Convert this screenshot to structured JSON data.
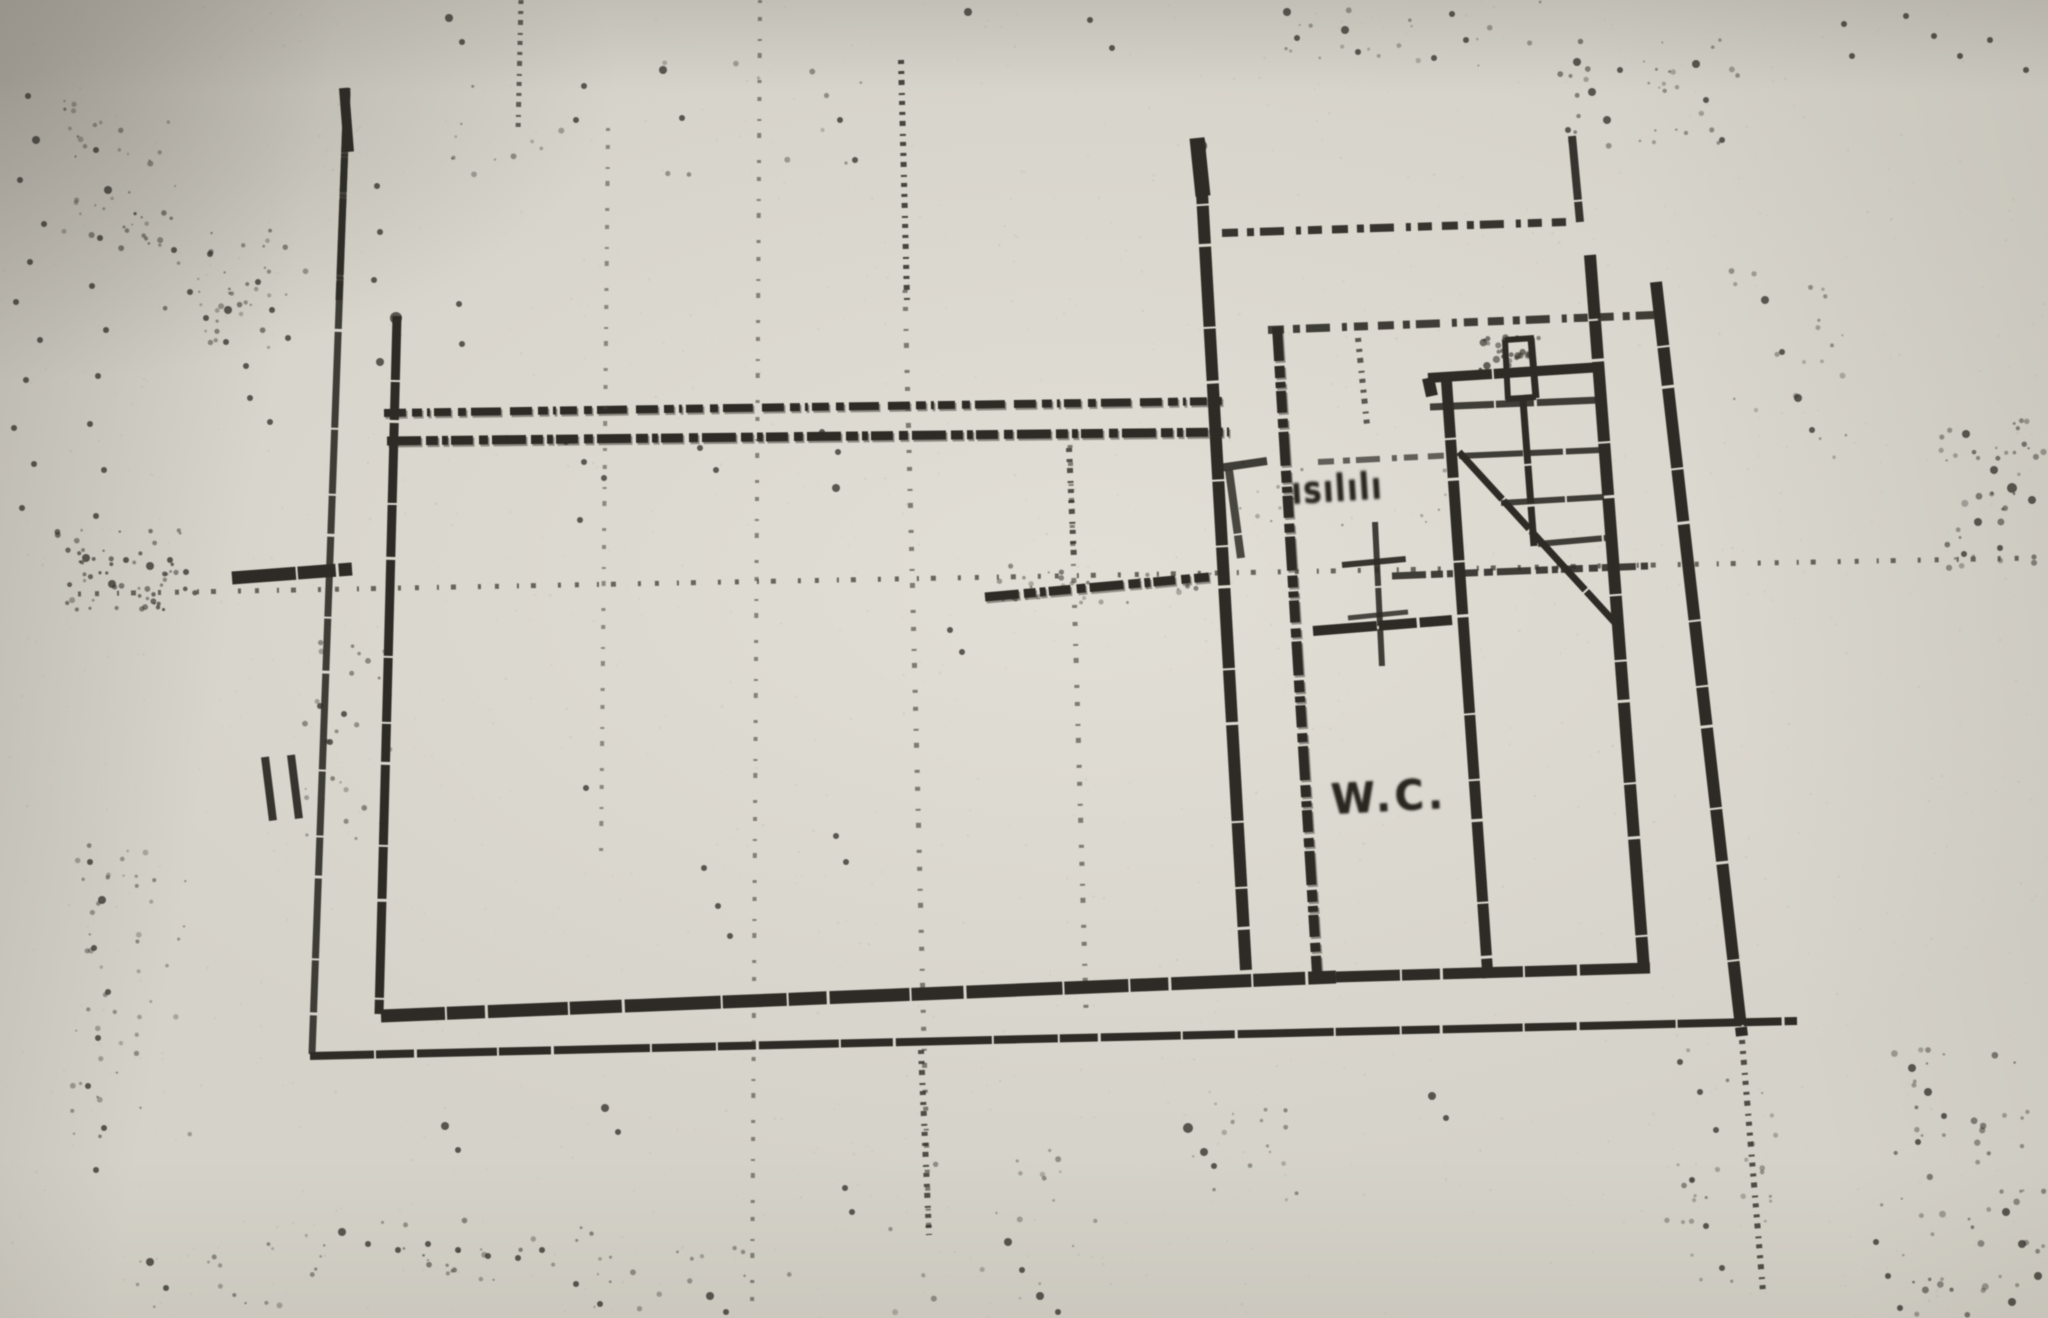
{
  "labels": {
    "wc": "W.C.",
    "stairs_annotation": "ısılılı"
  },
  "colors": {
    "paper": "#d5d2c9",
    "ink": "#2e2b26",
    "ink_faint": "#4a463f"
  },
  "plan": {
    "dash_presets": {
      "A": "22 6 10 5 3 4 17 7 8 5 30 9",
      "B": "34 5 12 4 6 3 22 6 9 4",
      "C": "16 9 7 6 24 12 5 7 14 10",
      "D": "4 7 3 6 5 8 2 6",
      "E": "3 14 4 18 2 12 5 22",
      "S": "64 2 38 3 80 2 52 3 96 2"
    },
    "solid": [
      [
        1199,
        140,
        1246,
        970,
        12,
        1
      ],
      [
        1197,
        138,
        1203,
        196,
        15,
        1
      ],
      [
        397,
        316,
        379,
        1014,
        9,
        1
      ],
      [
        381,
        1016,
        1336,
        977,
        13,
        1
      ],
      [
        1336,
        977,
        1650,
        968,
        11,
        1
      ],
      [
        1446,
        374,
        1488,
        978,
        11,
        1
      ],
      [
        1428,
        378,
        1602,
        367,
        10,
        1
      ],
      [
        1590,
        255,
        1644,
        970,
        12,
        1
      ],
      [
        1656,
        282,
        1742,
        1036,
        12,
        1
      ],
      [
        310,
        1056,
        1797,
        1021,
        8,
        1
      ],
      [
        347,
        88,
        312,
        1054,
        7,
        0.9
      ],
      [
        344,
        88,
        349,
        152,
        10,
        1
      ],
      [
        1313,
        631,
        1452,
        620,
        10,
        1
      ],
      [
        1523,
        400,
        1534,
        546,
        7,
        1
      ],
      [
        1459,
        452,
        1618,
        626,
        7,
        1
      ],
      [
        1505,
        340,
        1534,
        338,
        6,
        1
      ],
      [
        1505,
        340,
        1508,
        400,
        6,
        1
      ],
      [
        1531,
        338,
        1536,
        398,
        7,
        1
      ],
      [
        1506,
        399,
        1536,
        397,
        6,
        1
      ],
      [
        1375,
        522,
        1382,
        666,
        6,
        0.9
      ],
      [
        1342,
        565,
        1406,
        559,
        6,
        0.95
      ],
      [
        1348,
        618,
        1408,
        612,
        5,
        0.85
      ],
      [
        1572,
        136,
        1580,
        222,
        8,
        0.95
      ],
      [
        1430,
        407,
        1599,
        400,
        7,
        0.9
      ],
      [
        1459,
        456,
        1601,
        450,
        6,
        0.9
      ],
      [
        1501,
        503,
        1604,
        497,
        6,
        0.9
      ],
      [
        1538,
        544,
        1606,
        538,
        6,
        0.9
      ],
      [
        232,
        578,
        352,
        569,
        13,
        1
      ],
      [
        265,
        757,
        273,
        821,
        8,
        0.95
      ],
      [
        291,
        755,
        299,
        819,
        8,
        0.95
      ],
      [
        1219,
        468,
        1267,
        461,
        8,
        0.9
      ],
      [
        1229,
        470,
        1241,
        558,
        8,
        0.85
      ],
      [
        1428,
        378,
        1432,
        396,
        12,
        1
      ]
    ],
    "dashed": [
      [
        384,
        413,
        1226,
        401,
        8,
        "A",
        1,
        1
      ],
      [
        387,
        441,
        1229,
        432,
        9,
        "B",
        1,
        1
      ],
      [
        1222,
        233,
        1566,
        222,
        8,
        "C",
        0.95,
        0
      ],
      [
        1268,
        330,
        1654,
        315,
        8,
        "C",
        0.9,
        0
      ],
      [
        1277,
        327,
        1317,
        974,
        10,
        "B",
        1,
        1
      ],
      [
        78,
        594,
        2035,
        558,
        5,
        "E",
        0.8,
        0
      ],
      [
        985,
        597,
        1209,
        577,
        9,
        "B",
        1,
        1
      ],
      [
        1392,
        576,
        1648,
        566,
        7,
        "B",
        0.9,
        0
      ],
      [
        1318,
        462,
        1457,
        455,
        6,
        "C",
        0.7,
        0
      ],
      [
        1742,
        1040,
        1763,
        1292,
        6,
        "D",
        0.8,
        0
      ],
      [
        901,
        60,
        907,
        300,
        6,
        "D",
        0.85,
        0
      ],
      [
        521,
        0,
        518,
        132,
        5,
        "D",
        0.7,
        0
      ],
      [
        608,
        128,
        601,
        860,
        4,
        "E",
        0.55,
        0
      ],
      [
        760,
        0,
        752,
        1318,
        4,
        "E",
        0.6,
        0
      ],
      [
        905,
        290,
        929,
        1240,
        5,
        "E",
        0.65,
        0
      ],
      [
        921,
        1050,
        929,
        1235,
        6,
        "D",
        0.8,
        0
      ],
      [
        1070,
        445,
        1086,
        1008,
        5,
        "E",
        0.65,
        0
      ],
      [
        1069,
        448,
        1074,
        560,
        6,
        "D",
        0.8,
        0
      ],
      [
        1358,
        338,
        1367,
        425,
        6,
        "D",
        0.75,
        0
      ],
      [
        347,
        92,
        339,
        300,
        7,
        "S",
        0.85,
        0
      ]
    ],
    "specks": [
      [
        1287,
        12,
        4
      ],
      [
        1297,
        38,
        3
      ],
      [
        1345,
        30,
        4
      ],
      [
        1358,
        52,
        3
      ],
      [
        968,
        12,
        4
      ],
      [
        1090,
        20,
        3
      ],
      [
        1112,
        48,
        3
      ],
      [
        449,
        18,
        4
      ],
      [
        462,
        42,
        3
      ],
      [
        663,
        70,
        4
      ],
      [
        682,
        118,
        3
      ],
      [
        576,
        120,
        3
      ],
      [
        584,
        86,
        3
      ],
      [
        840,
        120,
        3
      ],
      [
        855,
        160,
        3
      ],
      [
        1577,
        62,
        4
      ],
      [
        1592,
        92,
        4
      ],
      [
        1607,
        120,
        4
      ],
      [
        1568,
        130,
        3
      ],
      [
        1620,
        70,
        3
      ],
      [
        1696,
        64,
        4
      ],
      [
        1706,
        100,
        3
      ],
      [
        1722,
        140,
        3
      ],
      [
        1844,
        24,
        3
      ],
      [
        1852,
        56,
        3
      ],
      [
        1960,
        56,
        3
      ],
      [
        1990,
        40,
        3
      ],
      [
        2026,
        70,
        3
      ],
      [
        1906,
        16,
        3
      ],
      [
        1934,
        36,
        3
      ],
      [
        1452,
        14,
        3
      ],
      [
        1466,
        40,
        3
      ],
      [
        1434,
        58,
        3
      ],
      [
        1765,
        300,
        4
      ],
      [
        1782,
        352,
        3
      ],
      [
        1798,
        398,
        4
      ],
      [
        1812,
        430,
        3
      ],
      [
        1966,
        434,
        4
      ],
      [
        1994,
        470,
        4
      ],
      [
        2012,
        488,
        5
      ],
      [
        2032,
        500,
        4
      ],
      [
        1978,
        522,
        4
      ],
      [
        2000,
        548,
        3
      ],
      [
        1964,
        554,
        3
      ],
      [
        700,
        448,
        3
      ],
      [
        716,
        470,
        3
      ],
      [
        566,
        442,
        3
      ],
      [
        584,
        462,
        3
      ],
      [
        604,
        478,
        3
      ],
      [
        822,
        432,
        3
      ],
      [
        838,
        452,
        3
      ],
      [
        836,
        488,
        4
      ],
      [
        580,
        520,
        3
      ],
      [
        950,
        630,
        3
      ],
      [
        962,
        652,
        3
      ],
      [
        836,
        836,
        3
      ],
      [
        846,
        862,
        3
      ],
      [
        586,
        788,
        3
      ],
      [
        704,
        868,
        3
      ],
      [
        718,
        906,
        3
      ],
      [
        730,
        936,
        3
      ],
      [
        605,
        1108,
        4
      ],
      [
        618,
        1132,
        3
      ],
      [
        445,
        1126,
        4
      ],
      [
        458,
        1150,
        3
      ],
      [
        342,
        1232,
        4
      ],
      [
        368,
        1244,
        3
      ],
      [
        398,
        1250,
        3
      ],
      [
        428,
        1244,
        3
      ],
      [
        458,
        1250,
        3
      ],
      [
        488,
        1256,
        3
      ],
      [
        518,
        1258,
        3
      ],
      [
        542,
        1250,
        3
      ],
      [
        150,
        1262,
        4
      ],
      [
        166,
        1288,
        3
      ],
      [
        576,
        1284,
        3
      ],
      [
        600,
        1304,
        3
      ],
      [
        710,
        1296,
        4
      ],
      [
        726,
        1312,
        3
      ],
      [
        845,
        1188,
        3
      ],
      [
        852,
        1212,
        3
      ],
      [
        1008,
        1242,
        4
      ],
      [
        1022,
        1270,
        3
      ],
      [
        1040,
        1296,
        4
      ],
      [
        1058,
        1312,
        3
      ],
      [
        1188,
        1128,
        5
      ],
      [
        1204,
        1152,
        4
      ],
      [
        1214,
        1166,
        3
      ],
      [
        1432,
        1096,
        4
      ],
      [
        1446,
        1118,
        3
      ],
      [
        1680,
        1062,
        3
      ],
      [
        1700,
        1092,
        3
      ],
      [
        1716,
        1130,
        3
      ],
      [
        1692,
        1180,
        3
      ],
      [
        1706,
        1226,
        3
      ],
      [
        1722,
        1268,
        3
      ],
      [
        1912,
        1068,
        4
      ],
      [
        1928,
        1092,
        4
      ],
      [
        1944,
        1116,
        3
      ],
      [
        1918,
        1142,
        3
      ],
      [
        2006,
        1212,
        4
      ],
      [
        2022,
        1244,
        4
      ],
      [
        2038,
        1276,
        4
      ],
      [
        2012,
        1302,
        4
      ],
      [
        1876,
        1242,
        3
      ],
      [
        1888,
        1276,
        3
      ],
      [
        1900,
        1308,
        3
      ],
      [
        28,
        96,
        3
      ],
      [
        36,
        140,
        4
      ],
      [
        20,
        180,
        3
      ],
      [
        44,
        224,
        3
      ],
      [
        30,
        262,
        3
      ],
      [
        16,
        302,
        3
      ],
      [
        40,
        340,
        3
      ],
      [
        26,
        380,
        3
      ],
      [
        14,
        428,
        3
      ],
      [
        34,
        464,
        3
      ],
      [
        22,
        508,
        3
      ],
      [
        96,
        150,
        3
      ],
      [
        108,
        190,
        4
      ],
      [
        100,
        238,
        3
      ],
      [
        92,
        286,
        3
      ],
      [
        106,
        330,
        3
      ],
      [
        98,
        376,
        3
      ],
      [
        90,
        424,
        3
      ],
      [
        104,
        470,
        3
      ],
      [
        96,
        516,
        3
      ],
      [
        86,
        558,
        4
      ],
      [
        112,
        584,
        4
      ],
      [
        126,
        560,
        3
      ],
      [
        150,
        566,
        4
      ],
      [
        170,
        560,
        3
      ],
      [
        186,
        572,
        3
      ],
      [
        174,
        250,
        3
      ],
      [
        190,
        292,
        3
      ],
      [
        206,
        318,
        3
      ],
      [
        226,
        342,
        3
      ],
      [
        246,
        366,
        3
      ],
      [
        210,
        254,
        3
      ],
      [
        258,
        282,
        3
      ],
      [
        272,
        310,
        3
      ],
      [
        288,
        338,
        3
      ],
      [
        250,
        398,
        3
      ],
      [
        270,
        422,
        3
      ],
      [
        228,
        310,
        4
      ],
      [
        320,
        706,
        3
      ],
      [
        330,
        742,
        3
      ],
      [
        344,
        714,
        3
      ],
      [
        90,
        862,
        3
      ],
      [
        102,
        900,
        4
      ],
      [
        94,
        948,
        3
      ],
      [
        108,
        992,
        3
      ],
      [
        98,
        1038,
        3
      ],
      [
        88,
        1086,
        3
      ],
      [
        104,
        1128,
        3
      ],
      [
        96,
        1170,
        3
      ],
      [
        377,
        186,
        3
      ],
      [
        380,
        232,
        3
      ],
      [
        374,
        280,
        3
      ],
      [
        459,
        304,
        3
      ],
      [
        462,
        344,
        3
      ],
      [
        380,
        362,
        4
      ],
      [
        396,
        318,
        6
      ],
      [
        1201,
        146,
        6
      ]
    ],
    "clusters": [
      [
        56,
        530,
        150,
        80,
        55,
        7,
        1,
        3,
        0.7
      ],
      [
        150,
        230,
        160,
        120,
        38,
        11,
        1,
        3,
        0.55
      ],
      [
        60,
        100,
        120,
        150,
        42,
        13,
        1,
        3,
        0.55
      ],
      [
        70,
        840,
        120,
        320,
        48,
        17,
        1,
        3,
        0.5
      ],
      [
        1560,
        40,
        180,
        110,
        32,
        19,
        1,
        3,
        0.55
      ],
      [
        1940,
        420,
        105,
        150,
        38,
        23,
        1,
        3.5,
        0.6
      ],
      [
        1880,
        1040,
        165,
        275,
        55,
        29,
        1,
        3.5,
        0.6
      ],
      [
        380,
        1220,
        220,
        60,
        22,
        37,
        1,
        3,
        0.55
      ],
      [
        1660,
        1050,
        120,
        240,
        26,
        41,
        1,
        3,
        0.5
      ],
      [
        300,
        640,
        90,
        200,
        28,
        43,
        1,
        3,
        0.5
      ],
      [
        1190,
        1100,
        120,
        100,
        16,
        47,
        1,
        3,
        0.5
      ],
      [
        420,
        60,
        500,
        120,
        22,
        53,
        1,
        3,
        0.45
      ],
      [
        1250,
        0,
        300,
        80,
        18,
        59,
        1,
        3,
        0.45
      ],
      [
        1730,
        240,
        120,
        220,
        20,
        61,
        1,
        3,
        0.45
      ],
      [
        840,
        1150,
        260,
        165,
        20,
        67,
        1,
        3,
        0.45
      ],
      [
        560,
        1240,
        240,
        75,
        16,
        71,
        1,
        3,
        0.5
      ],
      [
        130,
        1230,
        200,
        85,
        18,
        73,
        1,
        3,
        0.5
      ],
      [
        1480,
        336,
        60,
        36,
        24,
        77,
        1.5,
        4,
        0.8
      ],
      [
        985,
        565,
        230,
        38,
        30,
        83,
        1,
        3,
        0.55
      ],
      [
        1240,
        455,
        230,
        70,
        18,
        89,
        1,
        2.5,
        0.45
      ]
    ],
    "grain": [
      1700,
      9,
      0.4,
      1.3,
      0.09
    ]
  }
}
